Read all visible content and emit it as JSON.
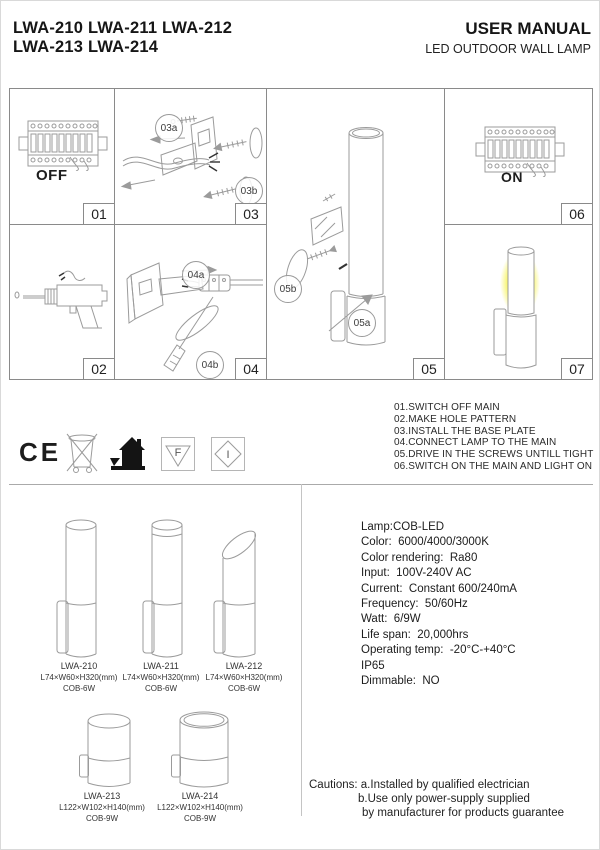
{
  "header": {
    "models_line1": "LWA-210 LWA-211 LWA-212",
    "models_line2": "LWA-213 LWA-214",
    "title": "USER MANUAL",
    "subtitle": "LED OUTDOOR WALL LAMP"
  },
  "steps": {
    "panel01": {
      "num": "01",
      "caption": "OFF"
    },
    "panel02": {
      "num": "02"
    },
    "panel03": {
      "num": "03",
      "label_a": "03a",
      "label_b": "03b"
    },
    "panel04": {
      "num": "04",
      "label_a": "04a",
      "label_b": "04b"
    },
    "panel05": {
      "num": "05",
      "label_top": "05b",
      "label_bottom": "05a"
    },
    "panel06": {
      "num": "06",
      "caption": "ON"
    },
    "panel07": {
      "num": "07"
    }
  },
  "instructions": {
    "lines": [
      "01.SWITCH OFF MAIN",
      "02.MAKE HOLE PATTERN",
      "03.INSTALL THE BASE PLATE",
      "04.CONNECT LAMP TO THE MAIN",
      "05.DRIVE IN THE SCREWS UNTILL TIGHT",
      "06.SWITCH ON THE MAIN AND LIGHT ON"
    ]
  },
  "certifications": {
    "ce_text": "CE",
    "f_mark_letter": "F",
    "class_mark_letter": "I",
    "icons": [
      "ce-mark",
      "weee-crossed-bin",
      "house-mark",
      "f-mark-triangle",
      "class-mark-diamond"
    ]
  },
  "products": {
    "row1": [
      {
        "model": "LWA-210",
        "size": "L74×W60×H320(mm)",
        "lamp": "COB-6W"
      },
      {
        "model": "LWA-211",
        "size": "L74×W60×H320(mm)",
        "lamp": "COB-6W"
      },
      {
        "model": "LWA-212",
        "size": "L74×W60×H320(mm)",
        "lamp": "COB-6W"
      }
    ],
    "row2": [
      {
        "model": "LWA-213",
        "size": "L122×W102×H140(mm)",
        "lamp": "COB-9W"
      },
      {
        "model": "LWA-214",
        "size": "L122×W102×H140(mm)",
        "lamp": "COB-9W"
      }
    ]
  },
  "specs": {
    "lines": [
      "Lamp:COB-LED",
      "Color:  6000/4000/3000K",
      "Color rendering:  Ra80",
      "Input:  100V-240V AC",
      "Current:  Constant 600/240mA",
      "Frequency:  50/60Hz",
      "Watt:  6/9W",
      "Life span:  20,000hrs",
      "Operating temp:  -20°C-+40°C",
      "IP65",
      "Dimmable:  NO"
    ]
  },
  "cautions": {
    "line1": "Cautions: a.Installed by qualified electrician",
    "line2": "b.Use only power-supply supplied",
    "line3": "by manufacturer for products guarantee"
  },
  "colors": {
    "light_glow": "#f6f23c",
    "line_gray": "#8a8a8a"
  }
}
